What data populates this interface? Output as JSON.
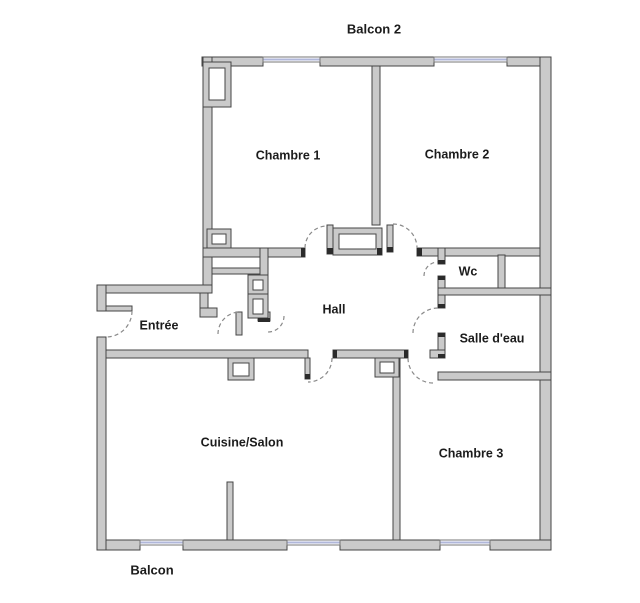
{
  "title": "Plan d'appartement",
  "rooms": [
    {
      "id": "balcon2",
      "label": "Balcon 2"
    },
    {
      "id": "chambre1",
      "label": "Chambre 1"
    },
    {
      "id": "chambre2",
      "label": "Chambre 2"
    },
    {
      "id": "wc",
      "label": "Wc"
    },
    {
      "id": "hall",
      "label": "Hall"
    },
    {
      "id": "entree",
      "label": "Entrée"
    },
    {
      "id": "salle-deau",
      "label": "Salle d'eau"
    },
    {
      "id": "cuisine-salon",
      "label": "Cuisine/Salon"
    },
    {
      "id": "chambre3",
      "label": "Chambre 3"
    },
    {
      "id": "balcon",
      "label": "Balcon"
    }
  ],
  "diagram": {
    "canvas": {
      "width": 640,
      "height": 603
    },
    "colors": {
      "background": "#ffffff",
      "wall_fill": "#cacaca",
      "wall_stroke": "#454545",
      "cap_fill": "#2b2b2b",
      "window_frame": "#777777",
      "window_glass": "#b0b7da",
      "door_arc": "#8a8a8a",
      "label": "#1c1c1c"
    },
    "walls": [
      [
        202,
        57,
        61,
        9
      ],
      [
        320,
        57,
        114,
        9
      ],
      [
        507,
        57,
        44,
        9
      ],
      [
        540,
        57,
        11,
        493
      ],
      [
        98,
        540,
        42,
        10
      ],
      [
        183,
        540,
        104,
        10
      ],
      [
        340,
        540,
        100,
        10
      ],
      [
        490,
        540,
        61,
        10
      ],
      [
        203,
        57,
        9,
        236
      ],
      [
        97,
        285,
        115,
        8
      ],
      [
        97,
        285,
        9,
        26
      ],
      [
        97,
        337,
        9,
        213
      ],
      [
        372,
        66,
        8,
        159
      ],
      [
        203,
        248,
        65,
        9
      ],
      [
        260,
        248,
        8,
        70
      ],
      [
        200,
        293,
        8,
        15
      ],
      [
        200,
        308,
        17,
        9
      ],
      [
        212,
        268,
        48,
        6
      ],
      [
        236,
        312,
        6,
        23
      ],
      [
        258,
        312,
        12,
        9
      ],
      [
        268,
        248,
        37,
        9
      ],
      [
        327,
        225,
        6,
        29
      ],
      [
        387,
        225,
        6,
        27
      ],
      [
        417,
        248,
        123,
        8
      ],
      [
        438,
        248,
        7,
        16
      ],
      [
        438,
        276,
        7,
        32
      ],
      [
        498,
        255,
        7,
        33
      ],
      [
        438,
        288,
        113,
        7
      ],
      [
        438,
        333,
        7,
        25
      ],
      [
        438,
        372,
        113,
        8
      ],
      [
        106,
        350,
        202,
        8
      ],
      [
        333,
        350,
        75,
        8
      ],
      [
        305,
        358,
        5,
        21
      ],
      [
        430,
        350,
        15,
        8
      ],
      [
        393,
        358,
        7,
        182
      ],
      [
        227,
        482,
        6,
        58
      ],
      [
        106,
        306,
        26,
        5
      ]
    ],
    "double_boxes": [
      {
        "o": [
          203,
          62,
          28,
          45
        ],
        "i": [
          209,
          68,
          16,
          32
        ]
      },
      {
        "o": [
          207,
          229,
          24,
          19
        ],
        "i": [
          212,
          234,
          14,
          10
        ]
      },
      {
        "o": [
          333,
          228,
          49,
          27
        ],
        "i": [
          339,
          234,
          37,
          15
        ]
      },
      {
        "o": [
          228,
          358,
          26,
          22
        ],
        "i": [
          233,
          363,
          16,
          13
        ]
      },
      {
        "o": [
          375,
          358,
          24,
          19
        ],
        "i": [
          380,
          362,
          14,
          11
        ]
      },
      {
        "o": [
          248,
          275,
          20,
          19
        ],
        "i": [
          253,
          280,
          10,
          10
        ]
      },
      {
        "o": [
          248,
          294,
          20,
          24
        ],
        "i": [
          253,
          299,
          10,
          15
        ]
      }
    ],
    "caps": [
      [
        301,
        248,
        4,
        9
      ],
      [
        327,
        248,
        6,
        6
      ],
      [
        387,
        247,
        6,
        5
      ],
      [
        417,
        248,
        5,
        8
      ],
      [
        438,
        260,
        7,
        4
      ],
      [
        438,
        276,
        7,
        4
      ],
      [
        438,
        304,
        7,
        4
      ],
      [
        438,
        333,
        7,
        4
      ],
      [
        438,
        354,
        7,
        4
      ],
      [
        333,
        350,
        4,
        8
      ],
      [
        404,
        350,
        4,
        8
      ],
      [
        258,
        318,
        12,
        4
      ],
      [
        305,
        374,
        5,
        5
      ],
      [
        377,
        248,
        5,
        7
      ]
    ],
    "windows": [
      [
        263,
        57,
        57,
        5
      ],
      [
        434,
        57,
        73,
        5
      ],
      [
        140,
        540,
        43,
        5
      ],
      [
        287,
        540,
        53,
        5
      ],
      [
        440,
        540,
        50,
        5
      ]
    ],
    "doors": [
      {
        "name": "entrance-door",
        "cx": 106,
        "cy": 311,
        "r": 26,
        "q": "se"
      },
      {
        "name": "closet-door-a",
        "cx": 240,
        "cy": 334,
        "r": 22,
        "q": "nw"
      },
      {
        "name": "closet-door-b",
        "cx": 268,
        "cy": 316,
        "r": 16,
        "q": "se"
      },
      {
        "name": "chambre1-door",
        "cx": 327,
        "cy": 248,
        "r": 22,
        "q": "nw"
      },
      {
        "name": "chambre2-door",
        "cx": 393,
        "cy": 248,
        "r": 24,
        "q": "ne"
      },
      {
        "name": "wc-door",
        "cx": 438,
        "cy": 276,
        "r": 14,
        "q": "nw"
      },
      {
        "name": "salle-deau-door",
        "cx": 438,
        "cy": 333,
        "r": 25,
        "q": "nw"
      },
      {
        "name": "cuisine-door",
        "cx": 308,
        "cy": 358,
        "r": 24,
        "q": "se"
      },
      {
        "name": "chambre3-door",
        "cx": 433,
        "cy": 358,
        "r": 25,
        "q": "sw"
      }
    ],
    "labels": [
      {
        "room": "balcon2",
        "text": "Balcon 2",
        "x": 374,
        "y": 30,
        "size": 13
      },
      {
        "room": "chambre1",
        "text": "Chambre 1",
        "x": 288,
        "y": 156,
        "size": 12.5
      },
      {
        "room": "chambre2",
        "text": "Chambre 2",
        "x": 457,
        "y": 155,
        "size": 12.5
      },
      {
        "room": "wc",
        "text": "Wc",
        "x": 468,
        "y": 272,
        "size": 12.5
      },
      {
        "room": "hall",
        "text": "Hall",
        "x": 334,
        "y": 310,
        "size": 12.5
      },
      {
        "room": "entree",
        "text": "Entrée",
        "x": 159,
        "y": 326,
        "size": 12.5
      },
      {
        "room": "salle-deau",
        "text": "Salle d'eau",
        "x": 492,
        "y": 339,
        "size": 12.5
      },
      {
        "room": "cuisine-salon",
        "text": "Cuisine/Salon",
        "x": 242,
        "y": 443,
        "size": 12.5
      },
      {
        "room": "chambre3",
        "text": "Chambre 3",
        "x": 471,
        "y": 454,
        "size": 12.5
      },
      {
        "room": "balcon",
        "text": "Balcon",
        "x": 152,
        "y": 571,
        "size": 13
      }
    ]
  }
}
